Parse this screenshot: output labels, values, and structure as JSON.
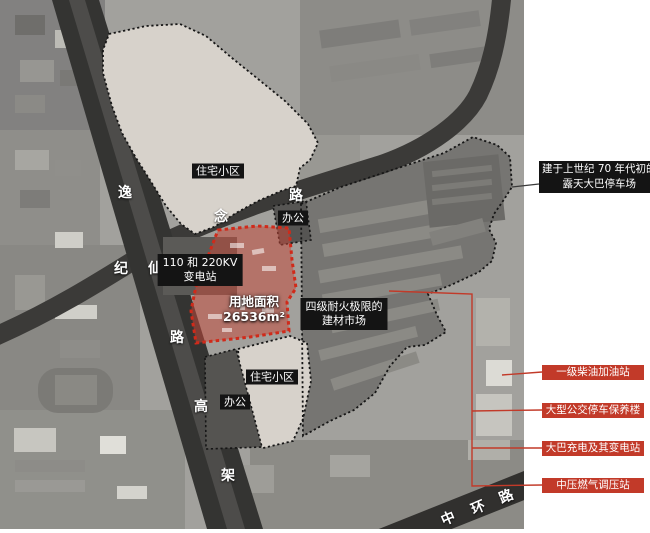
{
  "areas": {
    "residential_top": "住宅小区",
    "office_top": "办公",
    "substation": {
      "line1": "110 和 220KV",
      "line2": "变电站"
    },
    "site": {
      "line1": "用地面积",
      "line2": "26536m²"
    },
    "market": {
      "line1": "四级耐火极限的",
      "line2": "建材市场"
    },
    "residential_bottom": "住宅小区",
    "office_bottom": "办公"
  },
  "roads": {
    "yixian_chars": [
      "逸",
      "仙",
      "路",
      "高",
      "架"
    ],
    "jinian_chars": [
      "纪",
      "念",
      "路"
    ],
    "zhonghuan_chars": [
      "中",
      "环",
      "路"
    ]
  },
  "callouts": {
    "bus_parking": {
      "line1": "建于上世纪 70 年代初的",
      "line2": "露天大巴停车场"
    },
    "items": [
      {
        "label": "一级柴油加油站"
      },
      {
        "label": "大型公交停车保养楼"
      },
      {
        "label": "大巴充电及其变电站"
      },
      {
        "label": "中压燃气调压站"
      }
    ]
  },
  "colors": {
    "red_accent": "#c23a29",
    "site_fill": "rgba(198,72,58,0.52)",
    "site_border": "#d02a1a",
    "label_bg": "#141414",
    "residential_fill": "#d7d2cb",
    "road_dark": "#343432"
  }
}
